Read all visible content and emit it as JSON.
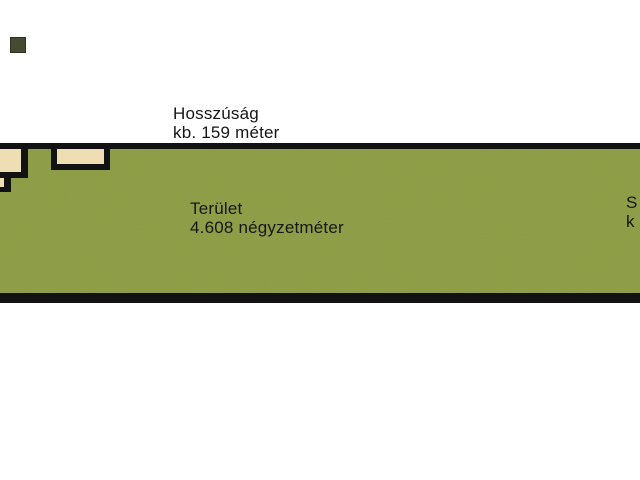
{
  "diagram": {
    "type": "land-parcel-site-plan",
    "labels": {
      "length": {
        "line1": "Hosszúság",
        "line2": "kb. 159 méter"
      },
      "area": {
        "line1": "Terület",
        "line2": "4.608 négyzetméter"
      },
      "side_clipped": {
        "line1": "S",
        "line2": "k"
      }
    },
    "values": {
      "length": "kb. 159 méter",
      "area": "4.608 négyzetméter"
    },
    "colors": {
      "background": "#ffffff",
      "parcel_green": "#8b9a43",
      "border_black": "#121212",
      "building_fill": "#efdeb4",
      "swatch_dark": "#454a33",
      "text": "#161616"
    }
  }
}
